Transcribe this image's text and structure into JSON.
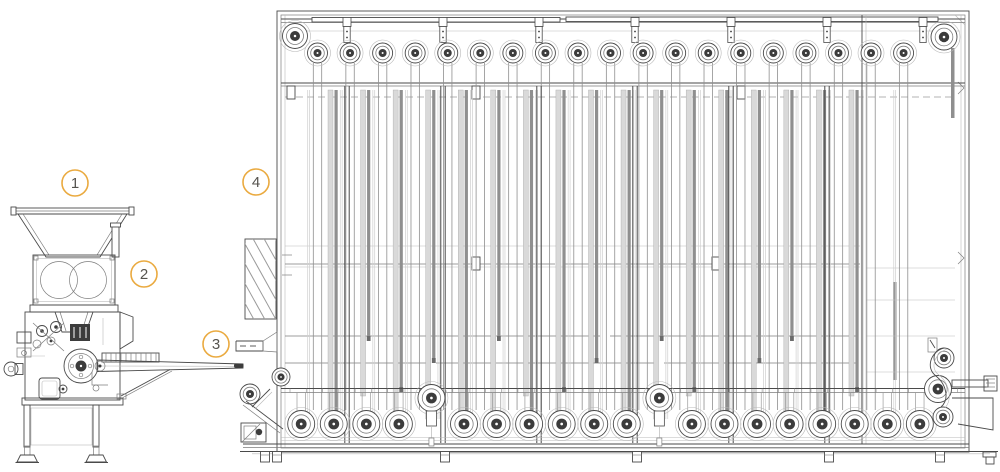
{
  "figure": {
    "kind": "technical line drawing",
    "subject": "Dough divider with hopper feeding an intermediate proofer cabinet via an outfeed conveyor",
    "background": "#ffffff"
  },
  "colors": {
    "accent": "#EAAA40",
    "callout_text": "#55534e",
    "line_dark": "#4a4a4a",
    "line_mid": "#7d7d7d",
    "line_light": "#b9b9b9",
    "bar_light": "#d9d9d9",
    "bar_dark": "#8f8f8f",
    "hub": "#3c3c3c"
  },
  "callouts": [
    {
      "label": "1",
      "x": 75,
      "y": 183
    },
    {
      "label": "2",
      "x": 144,
      "y": 274
    },
    {
      "label": "3",
      "x": 216,
      "y": 344
    },
    {
      "label": "4",
      "x": 256,
      "y": 182
    }
  ],
  "proofer": {
    "frame": {
      "x": 277,
      "y": 11,
      "w": 692,
      "h": 441
    },
    "top_pulleys": {
      "count": 19,
      "first_x": 317.5,
      "spacing": 32.56,
      "cy": 53,
      "r": 10
    },
    "corner_pulleys": [
      {
        "cx": 295,
        "cy": 36,
        "r": 12.5
      },
      {
        "cx": 944,
        "cy": 37,
        "r": 13
      }
    ],
    "aux_pulleys": [
      {
        "cx": 281,
        "cy": 377,
        "r": 9
      },
      {
        "cx": 250,
        "cy": 394,
        "r": 10
      },
      {
        "cx": 944,
        "cy": 358,
        "r": 10
      },
      {
        "cx": 938,
        "cy": 389,
        "r": 13.5
      },
      {
        "cx": 943,
        "cy": 417,
        "r": 10
      }
    ],
    "bottom_pulleys": {
      "count": 20,
      "first_x": 301.2,
      "spacing": 32.56,
      "cy": 424,
      "r": 13.5,
      "raised_cy": 398,
      "raised_indices": [
        4,
        11
      ]
    },
    "posts_x": [
      347,
      443,
      539,
      635,
      731,
      827
    ],
    "hanger_tabs_x": [
      347,
      443,
      539,
      635,
      731,
      827,
      923
    ],
    "feet_x": [
      265,
      277,
      445,
      637,
      829,
      940
    ],
    "bar_end_y": [
      415,
      341,
      392,
      363,
      415,
      341,
      415,
      392,
      363,
      415,
      341,
      392,
      415,
      363,
      341,
      415,
      392,
      363,
      341
    ],
    "hatch_panel": {
      "x": 245,
      "y": 239,
      "w": 31,
      "h": 80
    },
    "dashed_line_y": 97,
    "rail_tick_y": 388.5
  }
}
